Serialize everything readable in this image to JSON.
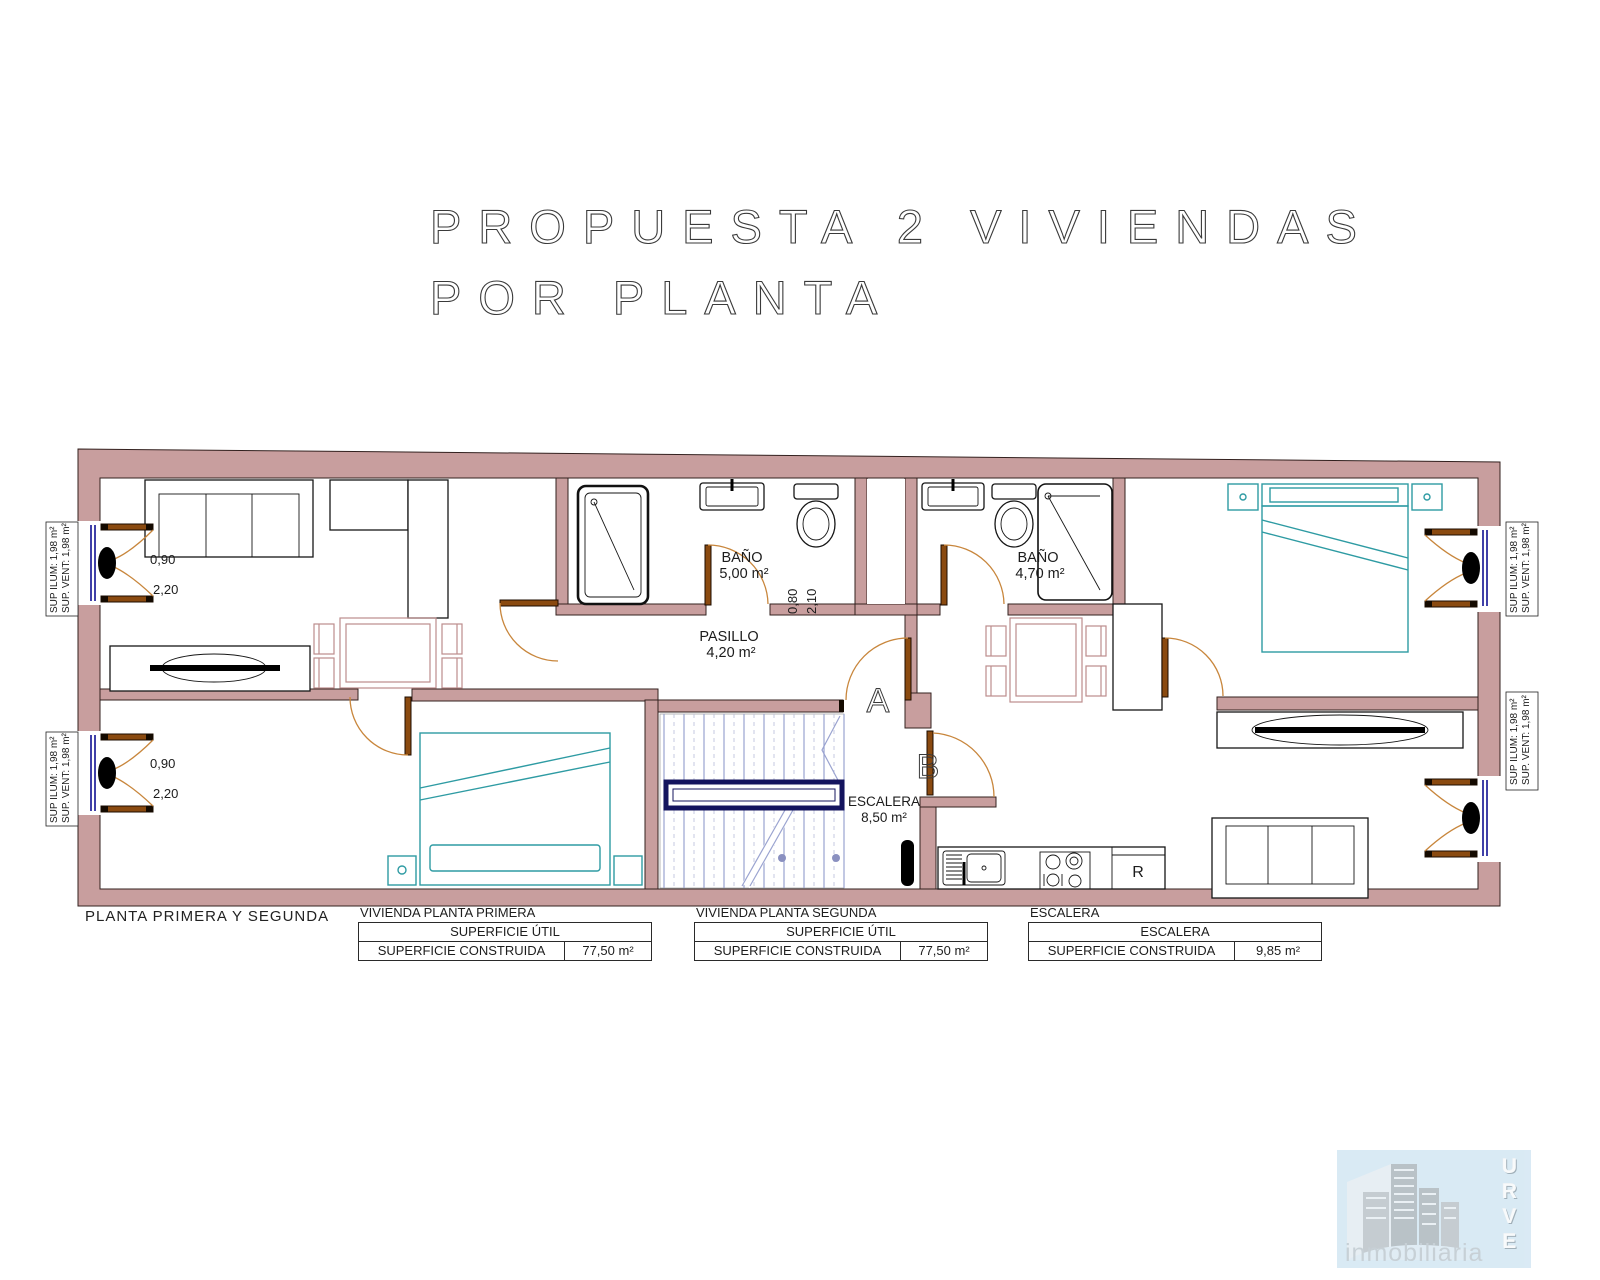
{
  "title": {
    "line1": "PROPUESTA 2 VIVIENDAS",
    "line2": "POR PLANTA"
  },
  "plan": {
    "bath_a": {
      "name": "BAÑO",
      "area": "5,00 m²"
    },
    "bath_b": {
      "name": "BAÑO",
      "area": "4,70 m²"
    },
    "hall": {
      "name": "PASILLO",
      "area": "4,20 m²"
    },
    "stairs": {
      "name": "ESCALERA",
      "area": "8,50 m²"
    },
    "unit_a_label": "A",
    "unit_b_label": "B",
    "fridge_label": "R",
    "balcony_door": {
      "width": "0,90",
      "height": "2,20"
    },
    "bath_door": {
      "width": "0,80",
      "height": "2,10"
    },
    "window_note": {
      "line1": "SUP ILUM: 1,98 m²",
      "line2": "SUP. VENT: 1,98 m²"
    }
  },
  "footer": {
    "caption": "PLANTA PRIMERA Y SEGUNDA",
    "tables": [
      {
        "title": "VIVIENDA PLANTA PRIMERA",
        "header": "SUPERFICIE ÚTIL",
        "row_label": "SUPERFICIE CONSTRUIDA",
        "row_value": "77,50 m²"
      },
      {
        "title": "VIVIENDA PLANTA SEGUNDA",
        "header": "SUPERFICIE ÚTIL",
        "row_label": "SUPERFICIE CONSTRUIDA",
        "row_value": "77,50 m²"
      },
      {
        "title": "ESCALERA",
        "header": "ESCALERA",
        "row_label": "SUPERFICIE CONSTRUIDA",
        "row_value": "9,85 m²"
      }
    ]
  },
  "logo": {
    "letters": [
      "U",
      "R",
      "V",
      "E"
    ],
    "subtitle": "inmobiliaria"
  },
  "colors": {
    "wall": "#c89e9e",
    "door": "#c8863c",
    "window": "#00008b",
    "bed": "#2e9ba3",
    "stair": "#9aa3d0",
    "table": "#bc8d8d",
    "logo_bg": "#d8e9f4"
  }
}
